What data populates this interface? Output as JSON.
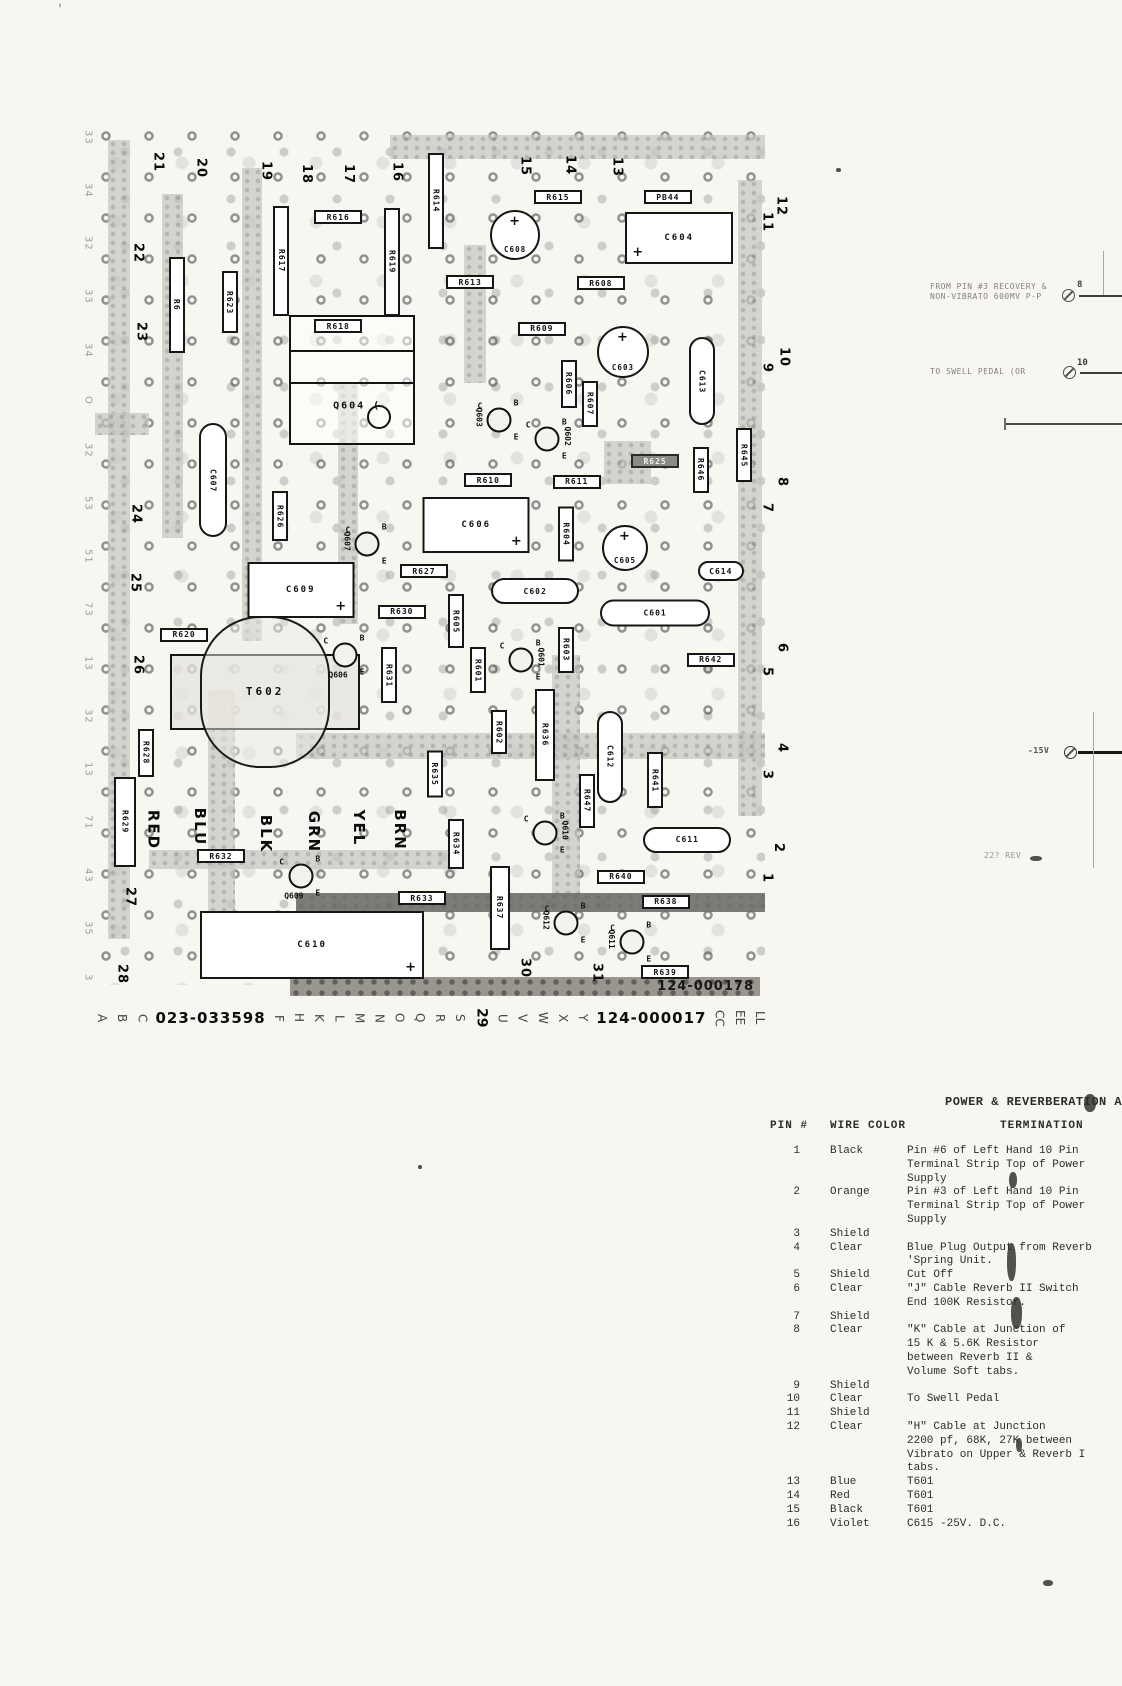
{
  "page": {
    "stamp": "124-000178"
  },
  "artifacts": {
    "corner_mark": "'",
    "smudges": [
      {
        "x": 1084,
        "y": 1094,
        "w": 12,
        "h": 18
      },
      {
        "x": 1007,
        "y": 1243,
        "w": 9,
        "h": 38
      },
      {
        "x": 1011,
        "y": 1297,
        "w": 11,
        "h": 32
      },
      {
        "x": 1016,
        "y": 1438,
        "w": 6,
        "h": 14
      },
      {
        "x": 1009,
        "y": 1172,
        "w": 8,
        "h": 16
      },
      {
        "x": 1030,
        "y": 856,
        "w": 12,
        "h": 5
      },
      {
        "x": 1043,
        "y": 1580,
        "w": 10,
        "h": 6
      },
      {
        "x": 418,
        "y": 1165,
        "w": 4,
        "h": 4
      },
      {
        "x": 836,
        "y": 168,
        "w": 5,
        "h": 4
      }
    ]
  },
  "board": {
    "traces": [
      {
        "x": 2,
        "y": 1.7,
        "w": 3.2,
        "h": 93
      },
      {
        "x": 10,
        "y": 8,
        "w": 3.2,
        "h": 40
      },
      {
        "x": 22,
        "y": 5,
        "w": 3,
        "h": 55
      },
      {
        "x": 44,
        "y": 1.2,
        "w": 56,
        "h": 2.8
      },
      {
        "x": 96,
        "y": 6.4,
        "w": 3.6,
        "h": 74
      },
      {
        "x": 55,
        "y": 14,
        "w": 3.4,
        "h": 16
      },
      {
        "x": 36.3,
        "y": 30,
        "w": 3,
        "h": 28
      },
      {
        "x": 0,
        "y": 33.5,
        "w": 8,
        "h": 2.5
      },
      {
        "x": 76,
        "y": 36.8,
        "w": 7,
        "h": 5
      },
      {
        "x": 16.9,
        "y": 65.7,
        "w": 4,
        "h": 26
      },
      {
        "x": 68.2,
        "y": 61.6,
        "w": 4.2,
        "h": 28
      },
      {
        "x": 30,
        "y": 70.7,
        "w": 70,
        "h": 3
      },
      {
        "x": 8,
        "y": 84.3,
        "w": 47,
        "h": 2.2
      },
      {
        "x": 30,
        "y": 89.3,
        "w": 70,
        "h": 2.2,
        "dark": true
      }
    ],
    "resistors_h": [
      {
        "l": "R616",
        "x": 36.3,
        "y": 10.7
      },
      {
        "l": "R615",
        "x": 69.1,
        "y": 8.4
      },
      {
        "l": "PB44",
        "x": 85.5,
        "y": 8.4
      },
      {
        "l": "R613",
        "x": 56.0,
        "y": 18.3
      },
      {
        "l": "R608",
        "x": 75.5,
        "y": 18.4
      },
      {
        "l": "R618",
        "x": 36.3,
        "y": 23.4
      },
      {
        "l": "R609",
        "x": 66.7,
        "y": 23.7
      },
      {
        "l": "R610",
        "x": 58.7,
        "y": 41.3
      },
      {
        "l": "R611",
        "x": 71.9,
        "y": 41.5
      },
      {
        "l": "R625",
        "x": 83.6,
        "y": 39.1,
        "dark": true
      },
      {
        "l": "R627",
        "x": 49.1,
        "y": 51.9
      },
      {
        "l": "R630",
        "x": 45.8,
        "y": 56.6
      },
      {
        "l": "R620",
        "x": 13.3,
        "y": 59.3
      },
      {
        "l": "R642",
        "x": 91.9,
        "y": 62.2
      },
      {
        "l": "R632",
        "x": 18.8,
        "y": 85.0
      },
      {
        "l": "R640",
        "x": 78.5,
        "y": 87.4
      },
      {
        "l": "R633",
        "x": 48.8,
        "y": 89.9
      },
      {
        "l": "R638",
        "x": 85.2,
        "y": 90.3
      },
      {
        "l": "R639",
        "x": 85.1,
        "y": 98.5
      }
    ],
    "resistors_v": [
      {
        "l": "R614",
        "x": 50.9,
        "y": 8.8,
        "h": 96
      },
      {
        "l": "R617",
        "x": 27.8,
        "y": 15.8,
        "h": 110
      },
      {
        "l": "R619",
        "x": 44.3,
        "y": 15.9,
        "h": 108
      },
      {
        "l": "R6",
        "x": 12.2,
        "y": 20.9,
        "h": 96
      },
      {
        "l": "R623",
        "x": 20.1,
        "y": 20.6,
        "h": 62
      },
      {
        "l": "R606",
        "x": 70.7,
        "y": 30.1,
        "h": 48
      },
      {
        "l": "R607",
        "x": 73.9,
        "y": 32.4,
        "h": 46
      },
      {
        "l": "R646",
        "x": 90.4,
        "y": 40.1,
        "h": 46
      },
      {
        "l": "R645",
        "x": 96.9,
        "y": 38.4,
        "h": 54
      },
      {
        "l": "R626",
        "x": 27.6,
        "y": 45.5,
        "h": 50
      },
      {
        "l": "R604",
        "x": 70.3,
        "y": 47.6,
        "h": 55
      },
      {
        "l": "R605",
        "x": 53.9,
        "y": 57.7,
        "h": 54
      },
      {
        "l": "R603",
        "x": 70.3,
        "y": 61.0,
        "h": 46
      },
      {
        "l": "R601",
        "x": 57.2,
        "y": 63.4,
        "h": 46
      },
      {
        "l": "R631",
        "x": 43.9,
        "y": 64.0,
        "h": 56
      },
      {
        "l": "R602",
        "x": 60.3,
        "y": 70.6,
        "h": 44
      },
      {
        "l": "R636",
        "x": 67.2,
        "y": 70.9,
        "h": 92,
        "w": 20
      },
      {
        "l": "R647",
        "x": 73.4,
        "y": 78.6,
        "h": 54
      },
      {
        "l": "R641",
        "x": 83.6,
        "y": 76.2,
        "h": 56
      },
      {
        "l": "R635",
        "x": 50.7,
        "y": 75.5,
        "h": 47
      },
      {
        "l": "R628",
        "x": 7.6,
        "y": 73.0,
        "h": 48
      },
      {
        "l": "R629",
        "x": 4.5,
        "y": 81.0,
        "h": 90,
        "w": 22
      },
      {
        "l": "R634",
        "x": 53.9,
        "y": 83.6,
        "h": 50
      },
      {
        "l": "R637",
        "x": 60.4,
        "y": 91.0,
        "h": 84,
        "w": 20
      }
    ],
    "caps_round": [
      {
        "l": "C608",
        "x": 62.7,
        "y": 12.8,
        "d": 50
      },
      {
        "l": "C603",
        "x": 78.8,
        "y": 26.4,
        "d": 52
      },
      {
        "l": "C605",
        "x": 79.1,
        "y": 49.2,
        "d": 46
      }
    ],
    "caps_rect": [
      {
        "l": "C604",
        "x": 87.2,
        "y": 13.1,
        "w": 108,
        "h": 52,
        "pp": "pl"
      },
      {
        "l": "C606",
        "x": 56.9,
        "y": 46.5,
        "w": 107,
        "h": 56,
        "pp": "pr"
      },
      {
        "l": "C609",
        "x": 30.7,
        "y": 54.1,
        "w": 107,
        "h": 56,
        "pp": "pr"
      },
      {
        "l": "C610",
        "x": 32.4,
        "y": 95.3,
        "w": 224,
        "h": 68,
        "pp": "pr"
      }
    ],
    "caps_pill": [
      {
        "l": "C613",
        "x": 90.6,
        "y": 29.8,
        "w": 26,
        "h": 88,
        "v": true
      },
      {
        "l": "C607",
        "x": 17.6,
        "y": 41.3,
        "w": 28,
        "h": 114,
        "v": true
      },
      {
        "l": "C614",
        "x": 93.4,
        "y": 51.9,
        "w": 46,
        "h": 20
      },
      {
        "l": "C602",
        "x": 65.7,
        "y": 54.2,
        "w": 88,
        "h": 26
      },
      {
        "l": "C601",
        "x": 83.6,
        "y": 56.7,
        "w": 110,
        "h": 27
      },
      {
        "l": "C612",
        "x": 76.9,
        "y": 73.5,
        "w": 26,
        "h": 92,
        "v": true
      },
      {
        "l": "C611",
        "x": 88.4,
        "y": 83.1,
        "w": 88,
        "h": 26
      }
    ],
    "transistors": [
      {
        "l": "Q603",
        "x": 60.3,
        "y": 34.3,
        "lp": "l"
      },
      {
        "l": "Q602",
        "x": 67.5,
        "y": 36.5,
        "lp": "r"
      },
      {
        "l": "Q607",
        "x": 40.6,
        "y": 48.7,
        "lp": "l"
      },
      {
        "l": "Q606",
        "x": 37.3,
        "y": 61.6,
        "lp": "b"
      },
      {
        "l": "Q601",
        "x": 63.6,
        "y": 62.2,
        "lp": "r"
      },
      {
        "l": "Q609",
        "x": 30.7,
        "y": 87.3,
        "lp": "b"
      },
      {
        "l": "Q610",
        "x": 67.2,
        "y": 82.3,
        "lp": "r"
      },
      {
        "l": "Q612",
        "x": 70.3,
        "y": 92.8,
        "lp": "l"
      },
      {
        "l": "Q611",
        "x": 80.1,
        "y": 95.0,
        "lp": "l"
      }
    ],
    "ic": {
      "l": "Q604 (",
      "x": 38.4,
      "y": 29.7,
      "w": 126,
      "h": 130
    },
    "transformer": {
      "l": "T602",
      "x": 25.4,
      "y": 65.9,
      "w": 190,
      "h": 76
    },
    "wire_colors": [
      {
        "t": "RED",
        "x": 8.7,
        "y": 82.0
      },
      {
        "t": "BLU",
        "x": 15.7,
        "y": 81.6
      },
      {
        "t": "BLK",
        "x": 25.5,
        "y": 82.4
      },
      {
        "t": "GRN",
        "x": 32.7,
        "y": 82.2
      },
      {
        "t": "YEL",
        "x": 39.4,
        "y": 81.7
      },
      {
        "t": "BRN",
        "x": 45.5,
        "y": 82.0
      }
    ],
    "pins_top": [
      {
        "n": "21",
        "x": 9.4,
        "y": 4.3
      },
      {
        "n": "20",
        "x": 15.8,
        "y": 5.0
      },
      {
        "n": "19",
        "x": 25.5,
        "y": 5.3
      },
      {
        "n": "18",
        "x": 31.6,
        "y": 5.7
      },
      {
        "n": "17",
        "x": 37.8,
        "y": 5.7
      },
      {
        "n": "16",
        "x": 45.1,
        "y": 5.5
      },
      {
        "n": "15",
        "x": 64.2,
        "y": 4.8
      },
      {
        "n": "14",
        "x": 70.9,
        "y": 4.7
      },
      {
        "n": "13",
        "x": 77.9,
        "y": 4.9
      }
    ],
    "pins_left": [
      {
        "n": "22",
        "x": 6.4,
        "y": 14.9
      },
      {
        "n": "23",
        "x": 6.9,
        "y": 24.1
      },
      {
        "n": "24",
        "x": 6.1,
        "y": 45.2
      },
      {
        "n": "25",
        "x": 6.0,
        "y": 53.3
      },
      {
        "n": "26",
        "x": 6.4,
        "y": 62.8
      },
      {
        "n": "27",
        "x": 5.2,
        "y": 89.8
      },
      {
        "n": "28",
        "x": 4.0,
        "y": 98.7
      }
    ],
    "pins_right": [
      {
        "n": "12",
        "x": 102.4,
        "y": 9.4
      },
      {
        "n": "11",
        "x": 100.3,
        "y": 11.3
      },
      {
        "n": "10",
        "x": 102.8,
        "y": 27.0
      },
      {
        "n": "9",
        "x": 100.3,
        "y": 28.3
      },
      {
        "n": "8",
        "x": 102.5,
        "y": 41.5
      },
      {
        "n": "7",
        "x": 100.3,
        "y": 44.5
      },
      {
        "n": "6",
        "x": 102.5,
        "y": 60.8
      },
      {
        "n": "5",
        "x": 100.3,
        "y": 63.6
      },
      {
        "n": "4",
        "x": 102.5,
        "y": 72.4
      },
      {
        "n": "3",
        "x": 100.3,
        "y": 75.6
      },
      {
        "n": "2",
        "x": 102.0,
        "y": 84.1
      },
      {
        "n": "1",
        "x": 100.3,
        "y": 87.6
      }
    ],
    "pins_bottom": [
      {
        "n": "30",
        "x": 64.2,
        "y": 98.0
      },
      {
        "n": "31",
        "x": 74.9,
        "y": 98.6
      }
    ]
  },
  "margin_glyphs": [
    "33",
    "34",
    "32",
    "33",
    "34",
    "O",
    "32",
    "53",
    "51",
    "73",
    "13",
    "32",
    "13",
    "71",
    "43",
    "35",
    "3"
  ],
  "bottom_row": {
    "items": [
      {
        "t": "A",
        "k": "letter"
      },
      {
        "t": "B",
        "k": "letter"
      },
      {
        "t": "C",
        "k": "letter"
      },
      {
        "t": "023-033598",
        "k": "num"
      },
      {
        "t": "F",
        "k": "letter"
      },
      {
        "t": "H",
        "k": "letter"
      },
      {
        "t": "K",
        "k": "letter"
      },
      {
        "t": "L",
        "k": "letter"
      },
      {
        "t": "M",
        "k": "letter"
      },
      {
        "t": "N",
        "k": "letter"
      },
      {
        "t": "O",
        "k": "letter"
      },
      {
        "t": "Q",
        "k": "letter"
      },
      {
        "t": "R",
        "k": "letter"
      },
      {
        "t": "S",
        "k": "letter"
      },
      {
        "t": "29",
        "k": "pin"
      },
      {
        "t": "U",
        "k": "letter"
      },
      {
        "t": "V",
        "k": "letter"
      },
      {
        "t": "W",
        "k": "letter"
      },
      {
        "t": "X",
        "k": "letter"
      },
      {
        "t": "Y",
        "k": "letter"
      },
      {
        "t": "124-000017",
        "k": "num"
      },
      {
        "t": "CC",
        "k": "letter"
      },
      {
        "t": "EE",
        "k": "letter"
      },
      {
        "t": "LL",
        "k": "letter"
      }
    ]
  },
  "annotations": {
    "note1": {
      "line1": "FROM PIN #3 RECOVERY &",
      "line2": "NON-VIBRATO 600MV P-P",
      "pin": "8"
    },
    "note2": {
      "text": "TO SWELL PEDAL (OR",
      "pin": "10"
    },
    "neg15v": {
      "text": "-15V"
    },
    "fragment": {
      "text": "22? REV"
    }
  },
  "table": {
    "title": "POWER & REVERBERATION AMPLI",
    "headers": [
      "PIN #",
      "WIRE COLOR",
      "TERMINATION"
    ],
    "rows": [
      {
        "pin": "1",
        "color": "Black",
        "term": "Pin #6 of Left Hand 10 Pin\nTerminal Strip Top of Power\nSupply"
      },
      {
        "pin": "2",
        "color": "Orange",
        "term": "Pin #3 of Left Hand 10 Pin\nTerminal Strip Top of Power\nSupply"
      },
      {
        "pin": "3",
        "color": "Shield",
        "term": ""
      },
      {
        "pin": "4",
        "color": "Clear",
        "term": "Blue Plug Output from Reverb\n'Spring Unit."
      },
      {
        "pin": "5",
        "color": "Shield",
        "term": "Cut Off"
      },
      {
        "pin": "6",
        "color": "Clear",
        "term": "\"J\" Cable  Reverb II Switch\nEnd 100K Resistor."
      },
      {
        "pin": "7",
        "color": "Shield",
        "term": ""
      },
      {
        "pin": "8",
        "color": "Clear",
        "term": "\"K\" Cable at Junction of\n15 K & 5.6K Resistor\nbetween Reverb II &\nVolume Soft tabs."
      },
      {
        "pin": "9",
        "color": "Shield",
        "term": ""
      },
      {
        "pin": "10",
        "color": "Clear",
        "term": "To Swell Pedal"
      },
      {
        "pin": "11",
        "color": "Shield",
        "term": ""
      },
      {
        "pin": "12",
        "color": "Clear",
        "term": "\"H\" Cable at Junction\n2200 pf, 68K, 27K between\nVibrato on Upper & Reverb I\ntabs."
      },
      {
        "pin": "13",
        "color": "Blue",
        "term": "T601"
      },
      {
        "pin": "14",
        "color": "Red",
        "term": "T601"
      },
      {
        "pin": "15",
        "color": "Black",
        "term": "T601"
      },
      {
        "pin": "16",
        "color": "Violet",
        "term": "C615 -25V. D.C."
      }
    ]
  }
}
